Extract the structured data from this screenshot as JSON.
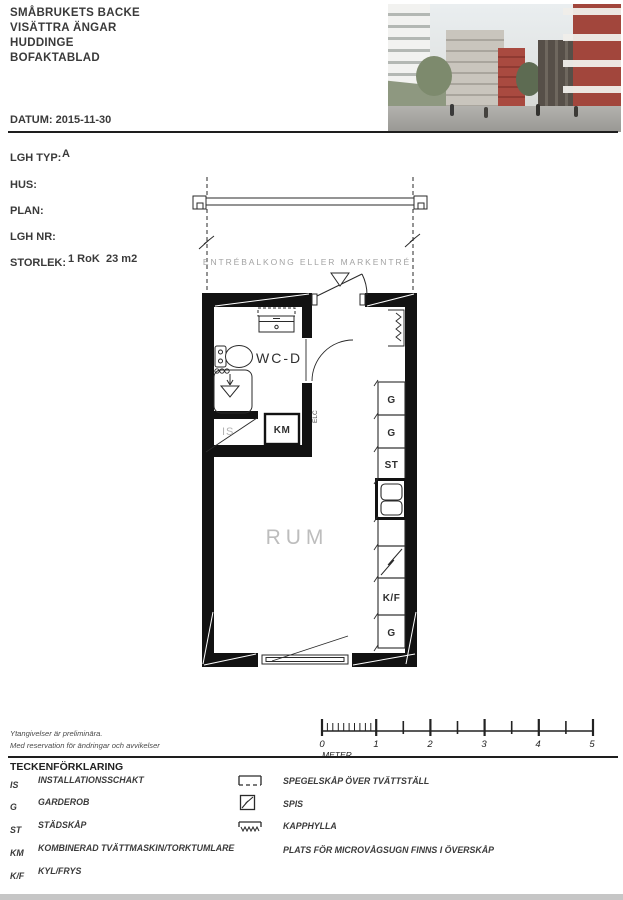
{
  "header": {
    "lines": [
      "SMÅBRUKETS BACKE",
      "VISÄTTRA ÄNGAR",
      "HUDDINGE",
      "BOFAKTABLAD"
    ],
    "date": "DATUM: 2015-11-30"
  },
  "info": {
    "rows": [
      {
        "label": "LGH TYP:",
        "value": "A",
        "value2": ""
      },
      {
        "label": "HUS:",
        "value": "",
        "value2": ""
      },
      {
        "label": "PLAN:",
        "value": "",
        "value2": ""
      },
      {
        "label": "LGH NR:",
        "value": "",
        "value2": ""
      },
      {
        "label": "STORLEK:",
        "value": "1 RoK",
        "value2": "23 m2"
      }
    ]
  },
  "plan": {
    "balcony_label": "ENTRÉBALKONG ELLER MARKENTRÉ",
    "labels": {
      "wc": "WC-D",
      "room": "RUM",
      "km": "KM",
      "is": "IS",
      "elc": "ELC"
    },
    "units": [
      "G",
      "G",
      "ST",
      "K/F",
      "G"
    ]
  },
  "scalebar": {
    "numbers": [
      "0",
      "1",
      "2",
      "3",
      "4",
      "5"
    ],
    "unit": "METER"
  },
  "disclaimer": {
    "line1": "Ytangivelser är preliminära.",
    "line2": "Med reservation för ändringar och avvikelser"
  },
  "legend": {
    "title": "TECKENFÖRKLARING",
    "left": [
      {
        "abbr": "IS",
        "desc": "INSTALLATIONSSCHAKT"
      },
      {
        "abbr": "G",
        "desc": "GARDEROB"
      },
      {
        "abbr": "ST",
        "desc": "STÄDSKÅP"
      },
      {
        "abbr": "KM",
        "desc": "KOMBINERAD TVÄTTMASKIN/TORKTUMLARE"
      },
      {
        "abbr": "K/F",
        "desc": "KYL/FRYS"
      }
    ],
    "right": [
      {
        "desc": "SPEGELSKÅP ÖVER TVÄTTSTÄLL"
      },
      {
        "desc": "SPIS"
      },
      {
        "desc": "KAPPHYLLA"
      },
      {
        "desc": "PLATS FÖR MICROVÅGSUGN FINNS I ÖVERSKÅP"
      }
    ]
  },
  "colors": {
    "ink": "#1a1a1a",
    "muted": "#a3a3a3",
    "brand_red": "#a2463c"
  }
}
